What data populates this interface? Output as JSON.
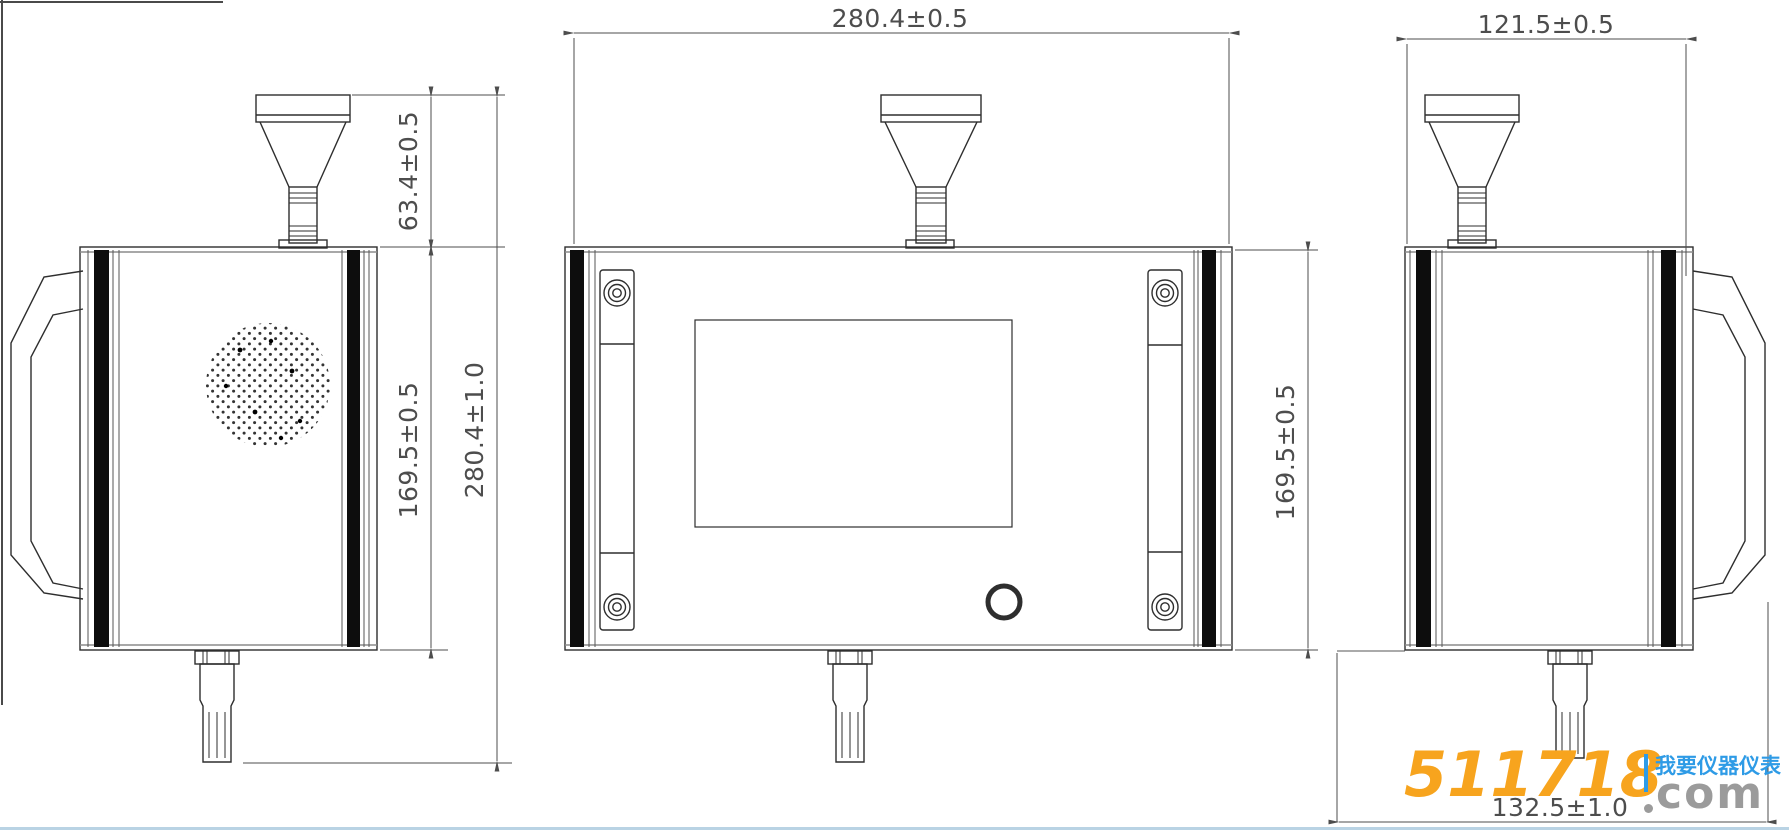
{
  "drawing_type": "dimensional engineering drawing, three views of a wall-mounted air quality sensor with rain-gauge funnel and bottom probe",
  "dimensions": {
    "front_width": "280.4±0.5",
    "side_depth": "121.5±0.5",
    "inlet_height": "63.4±0.5",
    "left_body_height": "169.5±0.5",
    "total_height": "280.4±1.0",
    "right_body_height": "169.5±0.5",
    "bottom_depth": "132.5±1.0"
  },
  "watermark": {
    "site_number": "511718",
    "site_tld": "com",
    "site_slogan": "我要仪器仪表"
  },
  "colors": {
    "line": "#2e2e2e",
    "dim_line": "#4d4d4d",
    "strip_black": "#0d0d0d",
    "edge_gray": "#8c8c8c",
    "watermark_orange": "#F7A41E",
    "watermark_blue": "#2E9BE6",
    "watermark_gray": "#9B9B9B",
    "bottom_rule_blue": "#B9D3E4"
  }
}
